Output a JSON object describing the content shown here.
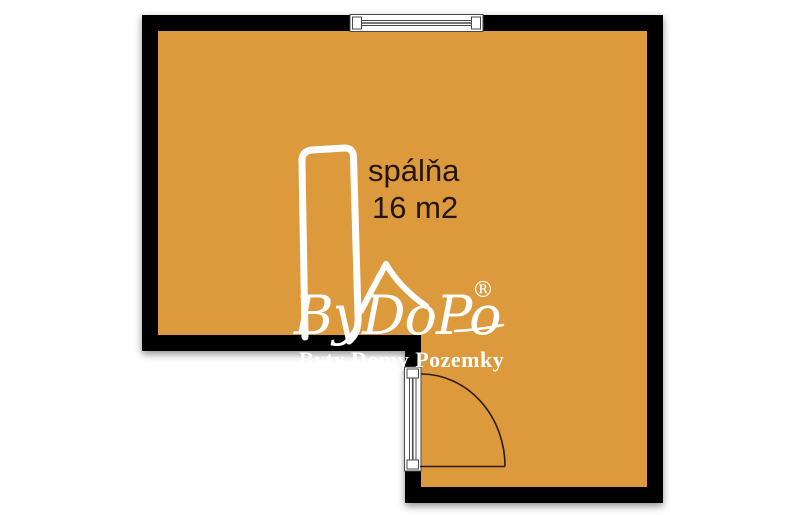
{
  "floor_plan": {
    "room_label": {
      "name": "spálňa",
      "area": "16 m2"
    },
    "watermark": {
      "brand": "ByDoPo",
      "registered_mark": "®",
      "tagline": "Byty Domy Pozemky"
    },
    "colors": {
      "background": "#ffffff",
      "floor": "#DC9A3E",
      "wall": "#050505",
      "room_text": "#231509",
      "watermark_text": "#ffffff",
      "door_arc": "#2B1B09",
      "symbol_fill": "#ffffff",
      "symbol_stroke": "#4a4a4a"
    }
  }
}
